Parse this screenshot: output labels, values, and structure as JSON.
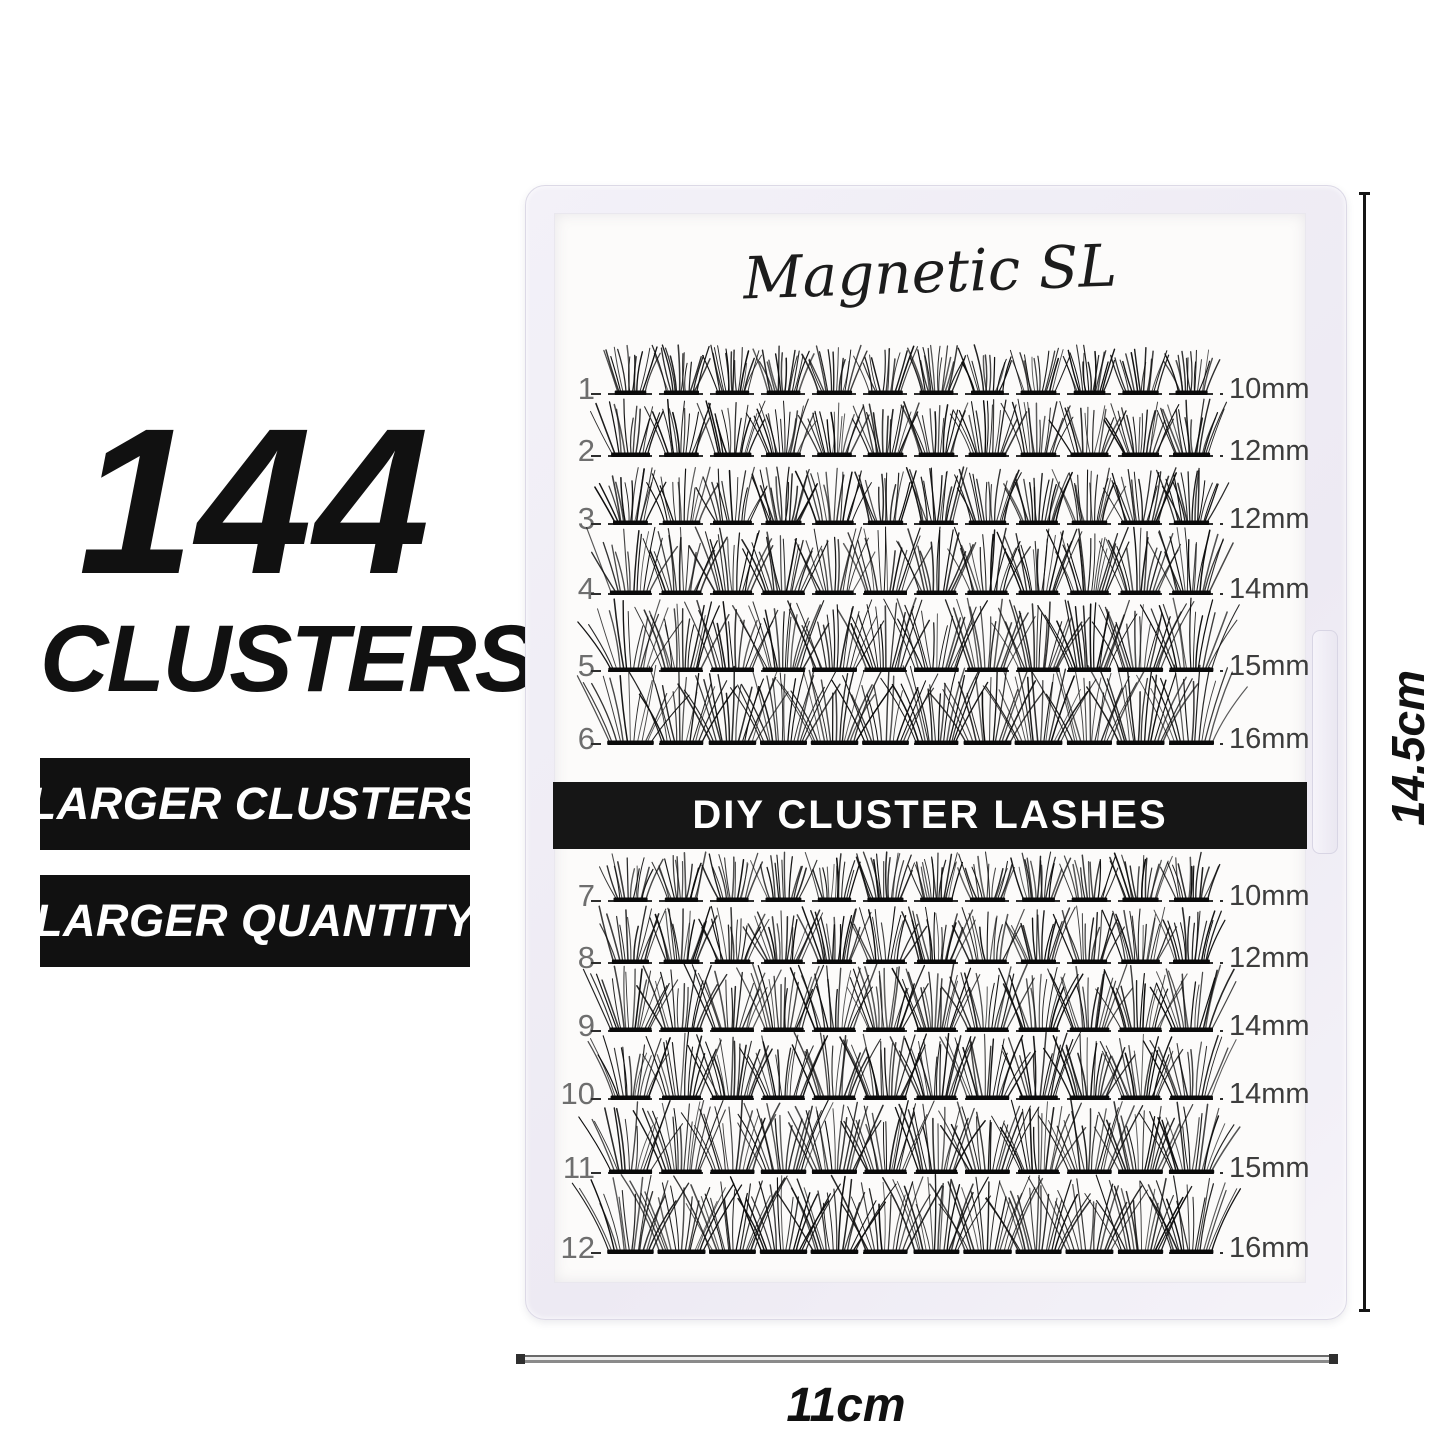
{
  "left_panel": {
    "headline_number": "144",
    "headline_word": "CLUSTERS",
    "badges": [
      {
        "label": "LARGER CLUSTERS"
      },
      {
        "label": "LARGER QUANTITY"
      }
    ]
  },
  "tray": {
    "brand": "Magnetic SL",
    "band_label": "DIY CLUSTER LASHES",
    "total_clusters": 144,
    "rows": [
      {
        "number": "1",
        "size": "10mm",
        "clusters": 12
      },
      {
        "number": "2",
        "size": "12mm",
        "clusters": 12
      },
      {
        "number": "3",
        "size": "12mm",
        "clusters": 12
      },
      {
        "number": "4",
        "size": "14mm",
        "clusters": 12
      },
      {
        "number": "5",
        "size": "15mm",
        "clusters": 12
      },
      {
        "number": "6",
        "size": "16mm",
        "clusters": 12
      },
      {
        "number": "7",
        "size": "10mm",
        "clusters": 12
      },
      {
        "number": "8",
        "size": "12mm",
        "clusters": 12
      },
      {
        "number": "9",
        "size": "14mm",
        "clusters": 12
      },
      {
        "number": "10",
        "size": "14mm",
        "clusters": 12
      },
      {
        "number": "11",
        "size": "15mm",
        "clusters": 12
      },
      {
        "number": "12",
        "size": "16mm",
        "clusters": 12
      }
    ]
  },
  "dimensions": {
    "height_label": "14.5cm",
    "width_label": "11cm"
  },
  "colors": {
    "badge_bg": "#111111",
    "badge_text": "#ffffff",
    "band_bg": "#161616",
    "lash_black": "#0c0c0c",
    "tray_frame": "#f0eef6",
    "tray_card": "#fcfbfa"
  }
}
